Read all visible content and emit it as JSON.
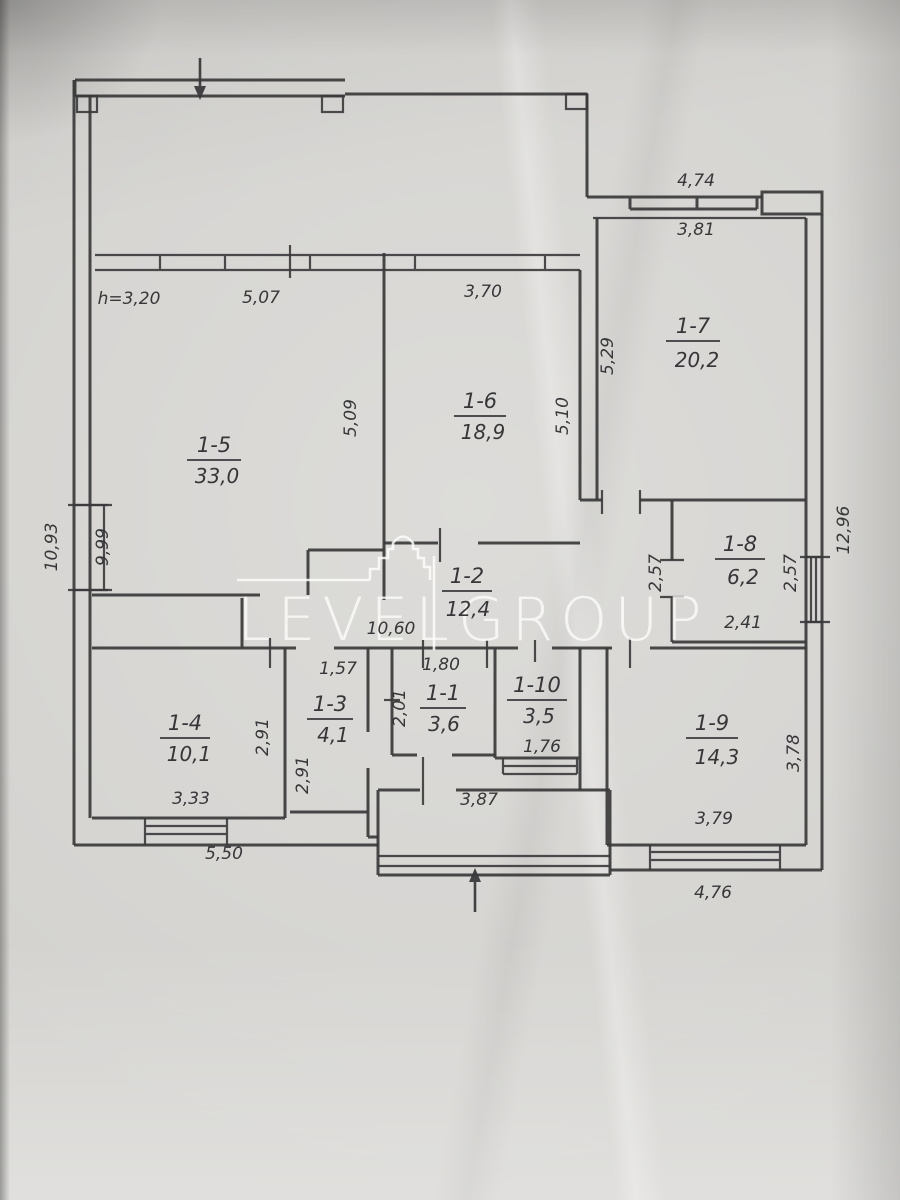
{
  "watermark": {
    "line1": "LEVEL",
    "line2": "GROUP"
  },
  "rooms": [
    {
      "num": "1-5",
      "area": "33,0",
      "x": 214,
      "y": 452,
      "ax": 217,
      "ay": 483,
      "ul": 54
    },
    {
      "num": "1-6",
      "area": "18,9",
      "x": 480,
      "y": 408,
      "ax": 483,
      "ay": 439,
      "ul": 52
    },
    {
      "num": "1-7",
      "area": "20,2",
      "x": 693,
      "y": 333,
      "ax": 697,
      "ay": 367,
      "ul": 54
    },
    {
      "num": "1-8",
      "area": "6,2",
      "x": 740,
      "y": 551,
      "ax": 743,
      "ay": 584,
      "ul": 50
    },
    {
      "num": "1-2",
      "area": "12,4",
      "x": 467,
      "y": 583,
      "ax": 468,
      "ay": 616,
      "ul": 50
    },
    {
      "num": "1-4",
      "area": "10,1",
      "x": 185,
      "y": 730,
      "ax": 189,
      "ay": 761,
      "ul": 50
    },
    {
      "num": "1-3",
      "area": "4,1",
      "x": 330,
      "y": 711,
      "ax": 333,
      "ay": 742,
      "ul": 46
    },
    {
      "num": "1-1",
      "area": "3,6",
      "x": 443,
      "y": 700,
      "ax": 444,
      "ay": 731,
      "ul": 46
    },
    {
      "num": "1-10",
      "area": "3,5",
      "x": 537,
      "y": 692,
      "ax": 539,
      "ay": 723,
      "ul": 60
    },
    {
      "num": "1-9",
      "area": "14,3",
      "x": 712,
      "y": 730,
      "ax": 717,
      "ay": 764,
      "ul": 52
    }
  ],
  "dimensions": [
    {
      "t": "h=3,20",
      "x": 129,
      "y": 304,
      "r": 0
    },
    {
      "t": "5,07",
      "x": 261,
      "y": 303,
      "r": 0
    },
    {
      "t": "3,70",
      "x": 483,
      "y": 297,
      "r": 0
    },
    {
      "t": "4,74",
      "x": 696,
      "y": 186,
      "r": 0
    },
    {
      "t": "3,81",
      "x": 696,
      "y": 235,
      "r": 0
    },
    {
      "t": "5,29",
      "x": 613,
      "y": 356,
      "r": -90
    },
    {
      "t": "5,10",
      "x": 568,
      "y": 416,
      "r": -90
    },
    {
      "t": "5,09",
      "x": 356,
      "y": 418,
      "r": -90
    },
    {
      "t": "10,93",
      "x": 57,
      "y": 547,
      "r": -90
    },
    {
      "t": "9,99",
      "x": 108,
      "y": 547,
      "r": -90
    },
    {
      "t": "12,96",
      "x": 849,
      "y": 530,
      "r": -90
    },
    {
      "t": "2,57",
      "x": 661,
      "y": 573,
      "r": -90
    },
    {
      "t": "2,57",
      "x": 796,
      "y": 573,
      "r": -90
    },
    {
      "t": "2,41",
      "x": 743,
      "y": 628,
      "r": 0
    },
    {
      "t": "10,60",
      "x": 391,
      "y": 634,
      "r": 0
    },
    {
      "t": "1,57",
      "x": 338,
      "y": 674,
      "r": 0
    },
    {
      "t": "1,80",
      "x": 441,
      "y": 670,
      "r": 0
    },
    {
      "t": "2,01",
      "x": 405,
      "y": 708,
      "r": -90
    },
    {
      "t": "2,91",
      "x": 268,
      "y": 737,
      "r": -90
    },
    {
      "t": "2,91",
      "x": 308,
      "y": 775,
      "r": -90
    },
    {
      "t": "1,76",
      "x": 542,
      "y": 752,
      "r": 0
    },
    {
      "t": "3,33",
      "x": 191,
      "y": 804,
      "r": 0
    },
    {
      "t": "5,50",
      "x": 224,
      "y": 859,
      "r": 0
    },
    {
      "t": "3,87",
      "x": 479,
      "y": 805,
      "r": 0
    },
    {
      "t": "3,78",
      "x": 799,
      "y": 753,
      "r": -90
    },
    {
      "t": "3,79",
      "x": 714,
      "y": 824,
      "r": 0
    },
    {
      "t": "4,76",
      "x": 713,
      "y": 898,
      "r": 0
    }
  ]
}
